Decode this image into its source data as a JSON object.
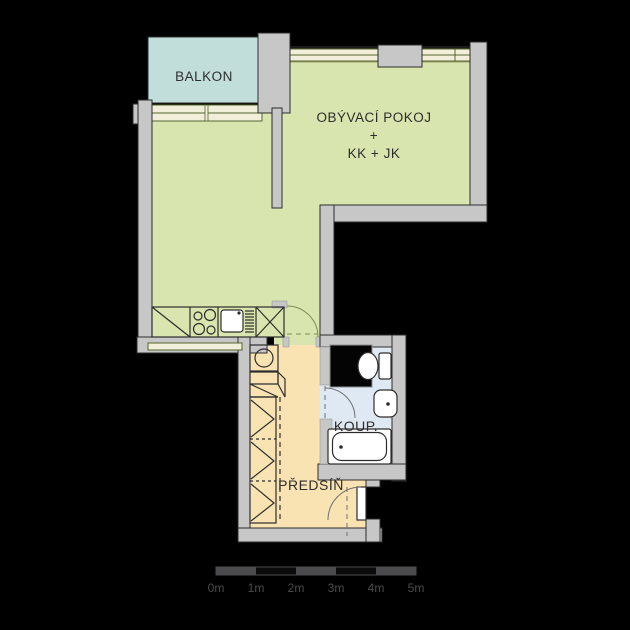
{
  "plan_title": "apartment-floor-plan",
  "rooms": {
    "balcony": {
      "label": "BALKON",
      "color": "#c2dedb"
    },
    "living_room": {
      "line1": "OBÝVACÍ POKOJ",
      "line2": "+",
      "line3": "KK + JK",
      "color": "#d9e5ae"
    },
    "bathroom": {
      "label": "KOUP.",
      "color": "#dfe9f3"
    },
    "hallway": {
      "label": "PŘEDSÍŇ",
      "color": "#fae3b2"
    }
  },
  "colors": {
    "background": "#000000",
    "wall": "#c7c7c7",
    "window_fill": "#f1eeda",
    "window_frame": "#55652e",
    "outline": "#2d2d2d",
    "fixture_fill": "#ffffff",
    "shaft": "#000000",
    "scale_bar": "#4b4b4d"
  },
  "fixtures": {
    "kitchen": [
      "base-cabinet",
      "stove",
      "sink",
      "fridge"
    ],
    "hallway": [
      "washing-machine",
      "cabinet",
      "wardrobe"
    ],
    "bathroom": [
      "toilet",
      "washbasin",
      "bathtub",
      "shaft"
    ]
  },
  "scale_bar": {
    "labels": [
      "0m",
      "1m",
      "2m",
      "3m",
      "4m",
      "5m"
    ]
  }
}
